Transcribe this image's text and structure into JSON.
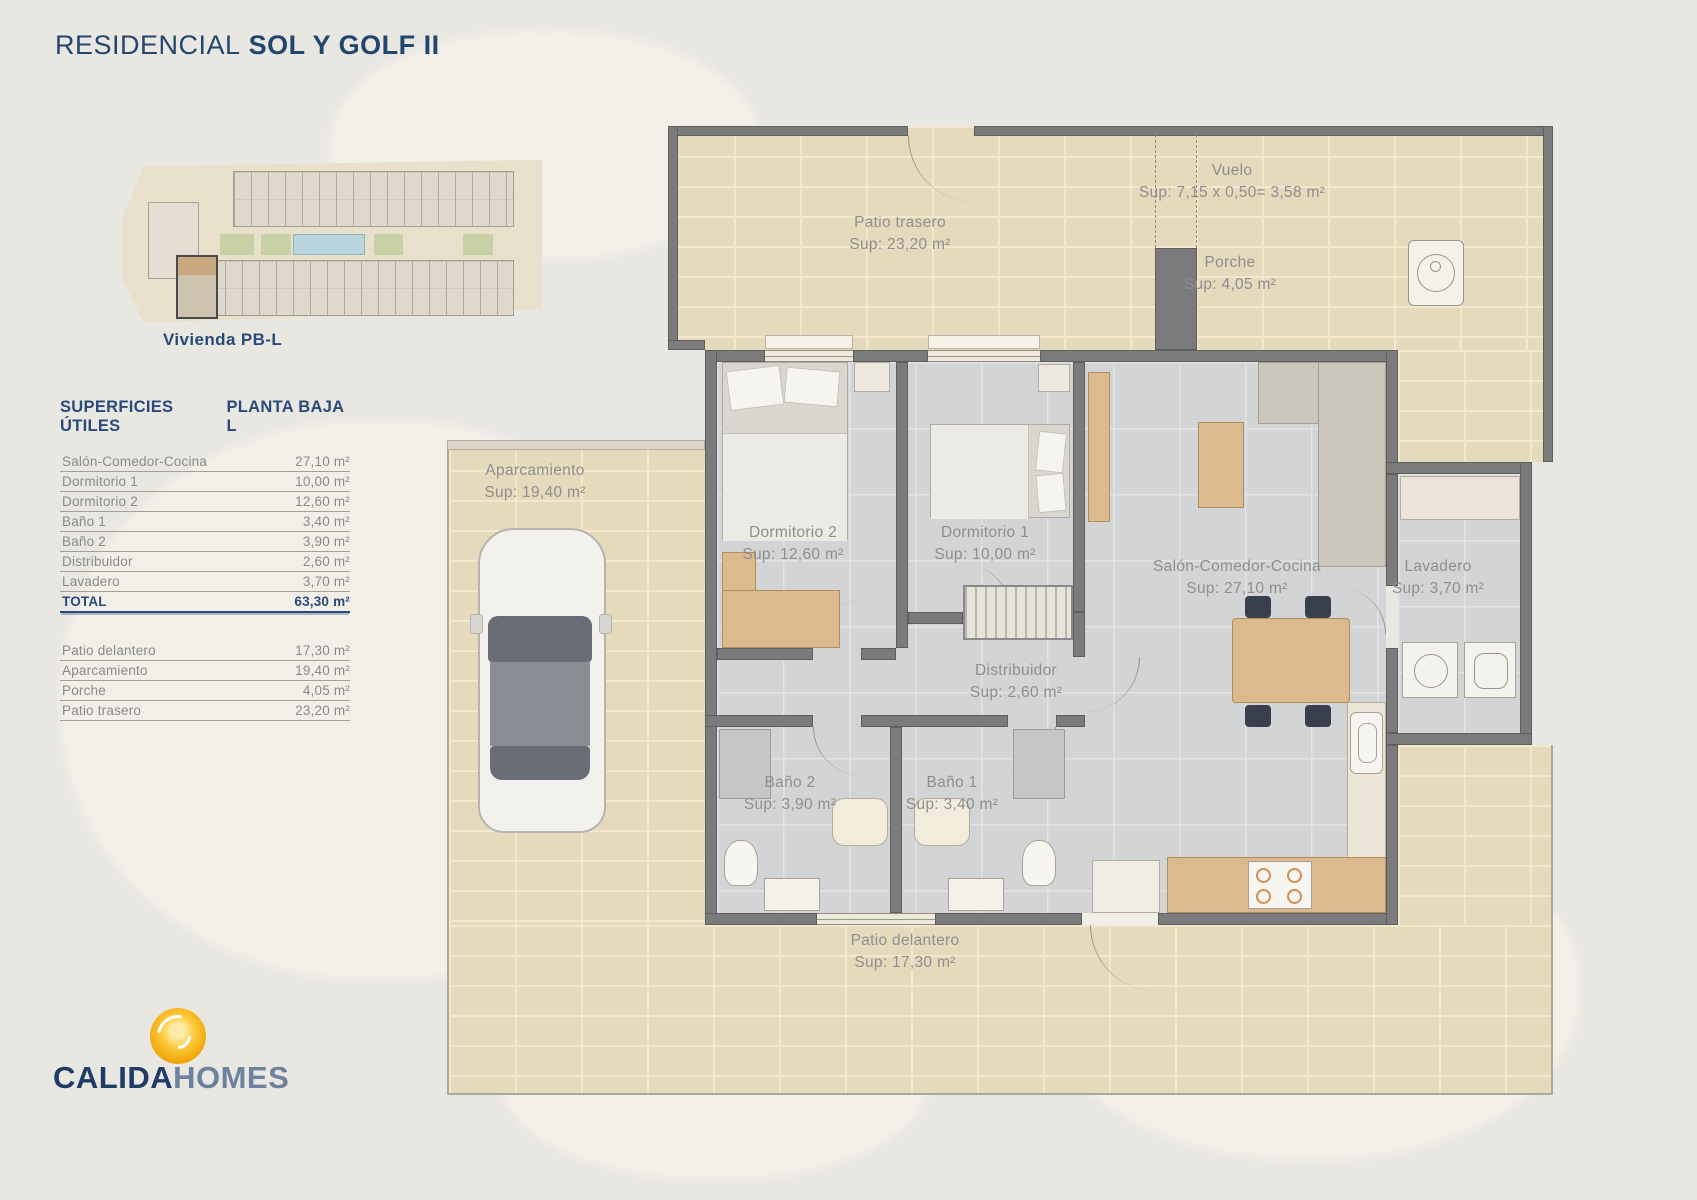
{
  "header": {
    "title_light": "RESIDENCIAL",
    "title_bold": "SOL Y GOLF II"
  },
  "site_plan": {
    "caption": "Vivienda PB-L"
  },
  "areas_table": {
    "title": "SUPERFICIES ÚTILES",
    "subtitle": "PLANTA BAJA L",
    "rows": [
      {
        "label": "Salón-Comedor-Cocina",
        "value": "27,10 m²"
      },
      {
        "label": "Dormitorio 1",
        "value": "10,00 m²"
      },
      {
        "label": "Dormitorio 2",
        "value": "12,60 m²"
      },
      {
        "label": "Baño 1",
        "value": "3,40 m²"
      },
      {
        "label": "Baño 2",
        "value": "3,90 m²"
      },
      {
        "label": "Distribuidor",
        "value": "2,60 m²"
      },
      {
        "label": "Lavadero",
        "value": "3,70 m²"
      }
    ],
    "total": {
      "label": "TOTAL",
      "value": "63,30 m²"
    },
    "exterior_rows": [
      {
        "label": "Patio delantero",
        "value": "17,30 m²"
      },
      {
        "label": "Aparcamiento",
        "value": "19,40 m²"
      },
      {
        "label": "Porche",
        "value": "4,05 m²"
      },
      {
        "label": "Patio trasero",
        "value": "23,20 m²"
      }
    ]
  },
  "floor_plan": {
    "rooms": [
      {
        "name": "Patio trasero",
        "sup": "Sup: 23,20 m²"
      },
      {
        "name": "Vuelo",
        "sup": "Sup: 7,15 x 0,50= 3,58 m²"
      },
      {
        "name": "Porche",
        "sup": "Sup: 4,05 m²"
      },
      {
        "name": "Aparcamiento",
        "sup": "Sup: 19,40 m²"
      },
      {
        "name": "Dormitorio 2",
        "sup": "Sup: 12,60 m²"
      },
      {
        "name": "Dormitorio 1",
        "sup": "Sup: 10,00 m²"
      },
      {
        "name": "Salón-Comedor-Cocina",
        "sup": "Sup: 27,10 m²"
      },
      {
        "name": "Lavadero",
        "sup": "Sup: 3,70 m²"
      },
      {
        "name": "Distribuidor",
        "sup": "Sup: 2,60 m²"
      },
      {
        "name": "Baño 2",
        "sup": "Sup: 3,90 m²"
      },
      {
        "name": "Baño 1",
        "sup": "Sup: 3,40 m²"
      },
      {
        "name": "Patio delantero",
        "sup": "Sup: 17,30 m²"
      }
    ]
  },
  "logo": {
    "brand_primary": "CALIDA",
    "brand_secondary": "HOMES"
  },
  "colors": {
    "accent_blue": "#24466e",
    "table_blue": "#2a4a7a",
    "label_gray": "#8e8e8e",
    "logo_orange": "#f2a90e",
    "wall_gray": "#7b7b7b"
  }
}
